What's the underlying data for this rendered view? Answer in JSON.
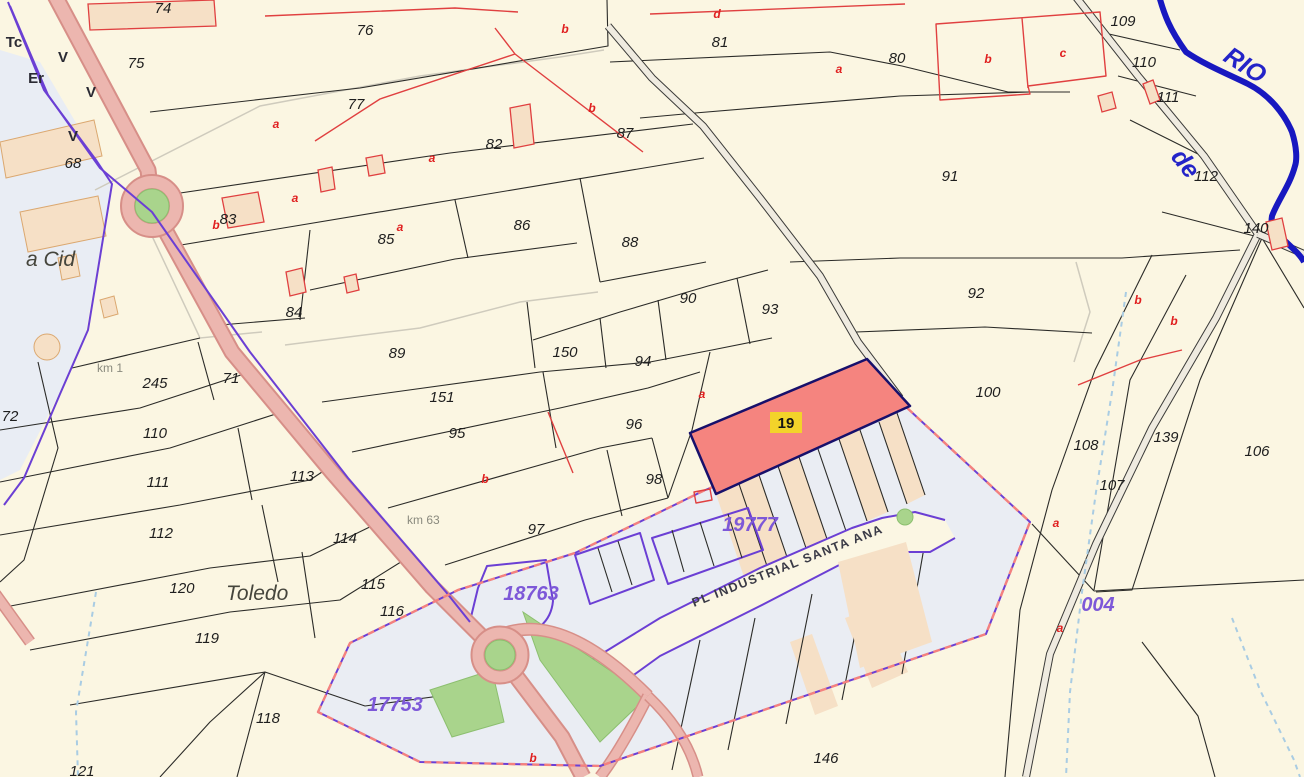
{
  "map": {
    "type": "cadastral-parcel-map",
    "colors": {
      "bg": "#FBF6E2",
      "urban": "#E9EDF4",
      "industrial": "#EAEDF3",
      "road": "#ECB6AF",
      "roadCasing": "#D78F88",
      "grayRoadFill": "#EFEBE0",
      "grayRoadEdge": "#3A3A38",
      "green": "#A9D48C",
      "greenStroke": "#8CBF6F",
      "river": "#1818C0",
      "stream": "#A9CCE3",
      "purple": "#6B3FD4",
      "pinkDash": "#F4817E",
      "parcelLine": "#2B2B28",
      "building": "#F6E0C6",
      "buildingStroke": "#E04040",
      "selFill": "#F5847F",
      "selStroke": "#17106B",
      "selLabelBg": "#F3D32A",
      "refText": "#7D58D8",
      "redText": "#E02020",
      "inkText": "#1E1E1E",
      "placeText": "#45453C",
      "kmText": "#8A8A7E",
      "streetText": "#3A3A46",
      "riverText": "#2424C8",
      "track": "#CFCBBD"
    },
    "selected_parcel": {
      "ref": "19",
      "fill": "#F5847F",
      "border": "#17106B",
      "label_bg": "#F3D32A"
    },
    "cadastral_refs": [
      "19777",
      "18763",
      "17753",
      "004"
    ],
    "street_name": "PL INDUSTRIAL SANTA ANA",
    "river_words": [
      "RIO",
      "de"
    ],
    "place_names": [
      "a Cid",
      "Toledo"
    ],
    "km_markers": [
      "km 1",
      "km 63"
    ],
    "landuse_marks": [
      "Tc",
      "Er",
      "V",
      "V",
      "V"
    ],
    "labels": [
      {
        "t": "74",
        "x": 163,
        "y": 13,
        "c": "p"
      },
      {
        "t": "75",
        "x": 136,
        "y": 68,
        "c": "p"
      },
      {
        "t": "76",
        "x": 365,
        "y": 35,
        "c": "p"
      },
      {
        "t": "77",
        "x": 356,
        "y": 109,
        "c": "p"
      },
      {
        "t": "81",
        "x": 720,
        "y": 47,
        "c": "p"
      },
      {
        "t": "80",
        "x": 897,
        "y": 63,
        "c": "p"
      },
      {
        "t": "87",
        "x": 625,
        "y": 138,
        "c": "p"
      },
      {
        "t": "91",
        "x": 950,
        "y": 181,
        "c": "p"
      },
      {
        "t": "68",
        "x": 73,
        "y": 168,
        "c": "p"
      },
      {
        "t": "82",
        "x": 494,
        "y": 149,
        "c": "p"
      },
      {
        "t": "83",
        "x": 228,
        "y": 224,
        "c": "p"
      },
      {
        "t": "85",
        "x": 386,
        "y": 244,
        "c": "p"
      },
      {
        "t": "86",
        "x": 522,
        "y": 230,
        "c": "p"
      },
      {
        "t": "88",
        "x": 630,
        "y": 247,
        "c": "p"
      },
      {
        "t": "84",
        "x": 294,
        "y": 317,
        "c": "p"
      },
      {
        "t": "90",
        "x": 688,
        "y": 303,
        "c": "p"
      },
      {
        "t": "93",
        "x": 770,
        "y": 314,
        "c": "p"
      },
      {
        "t": "92",
        "x": 976,
        "y": 298,
        "c": "p"
      },
      {
        "t": "89",
        "x": 397,
        "y": 358,
        "c": "p"
      },
      {
        "t": "150",
        "x": 565,
        "y": 357,
        "c": "p"
      },
      {
        "t": "94",
        "x": 643,
        "y": 366,
        "c": "p"
      },
      {
        "t": "151",
        "x": 442,
        "y": 402,
        "c": "p"
      },
      {
        "t": "95",
        "x": 457,
        "y": 438,
        "c": "p"
      },
      {
        "t": "96",
        "x": 634,
        "y": 429,
        "c": "p"
      },
      {
        "t": "100",
        "x": 988,
        "y": 397,
        "c": "p"
      },
      {
        "t": "71",
        "x": 231,
        "y": 383,
        "c": "p"
      },
      {
        "t": "245",
        "x": 155,
        "y": 388,
        "c": "p"
      },
      {
        "t": "72",
        "x": 10,
        "y": 421,
        "c": "p"
      },
      {
        "t": "110",
        "x": 155,
        "y": 438,
        "c": "p"
      },
      {
        "t": "111",
        "x": 158,
        "y": 487,
        "c": "p"
      },
      {
        "t": "113",
        "x": 302,
        "y": 481,
        "c": "p"
      },
      {
        "t": "98",
        "x": 654,
        "y": 484,
        "c": "p"
      },
      {
        "t": "97",
        "x": 536,
        "y": 534,
        "c": "p"
      },
      {
        "t": "112",
        "x": 161,
        "y": 538,
        "c": "p"
      },
      {
        "t": "114",
        "x": 345,
        "y": 543,
        "c": "p"
      },
      {
        "t": "120",
        "x": 182,
        "y": 593,
        "c": "p"
      },
      {
        "t": "115",
        "x": 373,
        "y": 589,
        "c": "p"
      },
      {
        "t": "116",
        "x": 392,
        "y": 616,
        "c": "p"
      },
      {
        "t": "119",
        "x": 207,
        "y": 643,
        "c": "p"
      },
      {
        "t": "118",
        "x": 268,
        "y": 723,
        "c": "p"
      },
      {
        "t": "121",
        "x": 82,
        "y": 776,
        "c": "p"
      },
      {
        "t": "146",
        "x": 826,
        "y": 763,
        "c": "p"
      },
      {
        "t": "108",
        "x": 1086,
        "y": 450,
        "c": "p"
      },
      {
        "t": "107",
        "x": 1112,
        "y": 490,
        "c": "p"
      },
      {
        "t": "139",
        "x": 1166,
        "y": 442,
        "c": "p"
      },
      {
        "t": "106",
        "x": 1257,
        "y": 456,
        "c": "p"
      },
      {
        "t": "109",
        "x": 1123,
        "y": 26,
        "c": "p"
      },
      {
        "t": "110",
        "x": 1144,
        "y": 67,
        "c": "p"
      },
      {
        "t": "111",
        "x": 1168,
        "y": 102,
        "c": "p"
      },
      {
        "t": "112",
        "x": 1206,
        "y": 181,
        "c": "p"
      },
      {
        "t": "140",
        "x": 1256,
        "y": 233,
        "c": "p"
      },
      {
        "t": "a",
        "x": 276,
        "y": 128,
        "c": "r"
      },
      {
        "t": "a",
        "x": 295,
        "y": 202,
        "c": "r"
      },
      {
        "t": "a",
        "x": 432,
        "y": 162,
        "c": "r"
      },
      {
        "t": "a",
        "x": 400,
        "y": 231,
        "c": "r"
      },
      {
        "t": "b",
        "x": 565,
        "y": 33,
        "c": "r"
      },
      {
        "t": "b",
        "x": 592,
        "y": 112,
        "c": "r"
      },
      {
        "t": "b",
        "x": 216,
        "y": 229,
        "c": "r"
      },
      {
        "t": "d",
        "x": 717,
        "y": 18,
        "c": "r"
      },
      {
        "t": "a",
        "x": 839,
        "y": 73,
        "c": "r"
      },
      {
        "t": "b",
        "x": 988,
        "y": 63,
        "c": "r"
      },
      {
        "t": "c",
        "x": 1063,
        "y": 57,
        "c": "r"
      },
      {
        "t": "b",
        "x": 1138,
        "y": 304,
        "c": "r"
      },
      {
        "t": "b",
        "x": 1174,
        "y": 325,
        "c": "r"
      },
      {
        "t": "a",
        "x": 702,
        "y": 398,
        "c": "r"
      },
      {
        "t": "b",
        "x": 485,
        "y": 483,
        "c": "r"
      },
      {
        "t": "a",
        "x": 1056,
        "y": 527,
        "c": "r"
      },
      {
        "t": "a",
        "x": 1060,
        "y": 632,
        "c": "r"
      },
      {
        "t": "b",
        "x": 533,
        "y": 762,
        "c": "r"
      },
      {
        "t": "19777",
        "x": 750,
        "y": 531,
        "c": "ref"
      },
      {
        "t": "18763",
        "x": 531,
        "y": 600,
        "c": "ref"
      },
      {
        "t": "17753",
        "x": 395,
        "y": 711,
        "c": "ref"
      },
      {
        "t": "004",
        "x": 1098,
        "y": 611,
        "c": "ref"
      },
      {
        "t": "a Cid",
        "x": 26,
        "y": 266,
        "c": "pl"
      },
      {
        "t": "Toledo",
        "x": 226,
        "y": 600,
        "c": "pl"
      },
      {
        "t": "km 1",
        "x": 97,
        "y": 372,
        "c": "km"
      },
      {
        "t": "km 63",
        "x": 407,
        "y": 524,
        "c": "km"
      },
      {
        "t": "PL INDUSTRIAL SANTA ANA",
        "x": 694,
        "y": 607,
        "c": "st",
        "r": -21.5
      },
      {
        "t": "RIO",
        "x": 1222,
        "y": 60,
        "c": "rio",
        "r": 33
      },
      {
        "t": "de",
        "x": 1170,
        "y": 157,
        "c": "rio",
        "r": 52
      },
      {
        "t": "Tc",
        "x": 14,
        "y": 47,
        "c": "lu"
      },
      {
        "t": "Er",
        "x": 36,
        "y": 83,
        "c": "lu"
      },
      {
        "t": "V",
        "x": 63,
        "y": 62,
        "c": "lu"
      },
      {
        "t": "V",
        "x": 91,
        "y": 97,
        "c": "lu"
      },
      {
        "t": "V",
        "x": 73,
        "y": 141,
        "c": "lu"
      }
    ]
  }
}
